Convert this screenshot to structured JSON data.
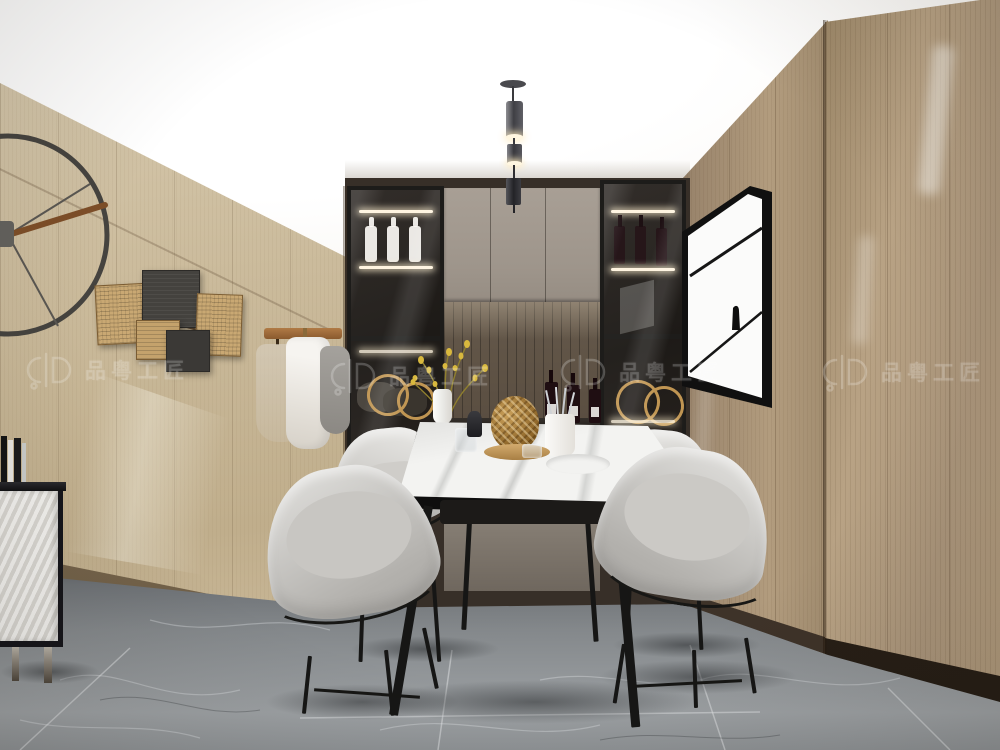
{
  "title": "Modern dining room interior 3D render",
  "watermark": {
    "text": "品粤工匠",
    "color": "#ffffff",
    "repeats": 4
  },
  "palette": {
    "ceiling": "#f7f4ef",
    "wall-left-light": "#d8cbb0",
    "wall-left-dark": "#c0ae8c",
    "wall-right": "#b29c7e",
    "cabinet-door": "#9e958b",
    "cabinet-drawer": "#877f75",
    "niche-wood": "#5a4e41",
    "frame-black": "#1d1c1a",
    "led-glow": "#fff4df",
    "marble": "#f3f3f1",
    "chair-fabric": "#d7d6d3",
    "chair-fabric-dark": "#b3b1ad",
    "floor-light": "#9da1a4",
    "floor-dark": "#54575b",
    "brass": "#c09552",
    "watermark-color": "#ffffff"
  },
  "scene": {
    "objects": [
      "wall clock",
      "rattan wall panels",
      "coat rack with garments",
      "built-in cabinet with two glass wine columns",
      "white wine bottles",
      "red wine bottles",
      "yellow flower vase",
      "gold ring ornaments",
      "pendant light",
      "abstract wall artwork",
      "marble dining table",
      "four gray barrel chairs",
      "white ribbed sideboard with books",
      "gray marble tile floor",
      "wood wardrobe panel"
    ]
  }
}
